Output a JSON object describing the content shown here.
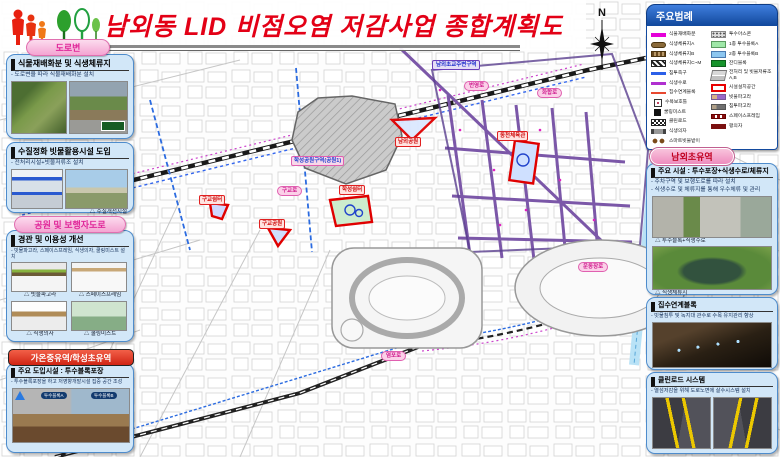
{
  "header": {
    "title": "남외동 LID 비점오염 저감사업 종합계획도"
  },
  "left_column": {
    "pill_road": "도로변",
    "panel1": {
      "title": "식물재배화분 및 식생체류지",
      "subtitle": "- 도로변을 따라 식물재배화분 설치"
    },
    "panel2": {
      "title": "수질정화 빗물활용시설 도입",
      "subtitle": "- 전처리시설+빗물저류조 설치",
      "caption": "△ 수질개선시설"
    },
    "pill_park": "공원 및 보행자도로",
    "panel3": {
      "title": "경관 및 이용성 개선",
      "subtitle": "- 빗물파고라, 스페이스프레임, 식생의자, 쿨링미스트 설치",
      "captions": [
        "△ 빗물파고라",
        "△ 스페이스프레임",
        "△ 식생의자",
        "△ 쿨링미스트"
      ]
    },
    "pill_watershed": "가온중유역/학성초유역",
    "panel4": {
      "title": "주요 도입시설 : 투수블록포장",
      "subtitle": "- 투수블록포장을 하고 저영향개발시설 집중 공간 조성",
      "image_tags": [
        "투수블록A",
        "투수블록B"
      ]
    }
  },
  "legend": {
    "title": "주요범례",
    "left": [
      {
        "label": "식물재배화분"
      },
      {
        "label": "식생체류지A"
      },
      {
        "label": "식생체류지B"
      },
      {
        "label": "식생체류지C~M"
      },
      {
        "label": "침투측구"
      },
      {
        "label": "식생수로"
      },
      {
        "label": "집수연계블록"
      },
      {
        "label": "수목보호틀"
      },
      {
        "label": "쿨링미스트"
      },
      {
        "label": "클린로드"
      },
      {
        "label": "식생의자"
      },
      {
        "label": "스마트빗물받이"
      }
    ],
    "right": [
      {
        "label": "투수아스콘"
      },
      {
        "label": "1종 투수블록A"
      },
      {
        "label": "2종 투수블록B"
      },
      {
        "label": "잔디블록"
      },
      {
        "label": "전처리 및 빗물저류조A,B"
      },
      {
        "label": "시설설치공간"
      },
      {
        "label": "빗물파고라"
      },
      {
        "label": "침투파고라"
      },
      {
        "label": "스페이스프레임"
      },
      {
        "label": "평의자"
      }
    ]
  },
  "right_column": {
    "pill": "남외초유역",
    "panelA": {
      "title": "주요 시설 : 투수포장+식생수로/체류지",
      "subtitle1": "- 주차구역 및 보행도로를 따라 설치",
      "subtitle2": "- 식생수로 및 체류지를 통해 우수체류 및 관리",
      "caption1": "△ 투수블록+식생수로",
      "caption2": "△ 식생체류지"
    },
    "panelB": {
      "title": "집수연계블록",
      "subtitle": "- 빗물침투 및 녹지대 관수로 수목 유지관리 향상"
    },
    "panelC": {
      "title": "클린로드 시스템",
      "subtitle": "- 열섬저감을 위해 도로노면에 살수시스템 설치"
    }
  },
  "map": {
    "compass": "N",
    "labels": [
      {
        "text": "남외초교주변구역"
      },
      {
        "text": "번영로"
      },
      {
        "text": "화합로"
      },
      {
        "text": "구교로"
      },
      {
        "text": "염포로"
      },
      {
        "text": "운동장로"
      },
      {
        "text": "학성공원구역(공원1)"
      },
      {
        "text": "남외공원"
      },
      {
        "text": "동천체육관"
      },
      {
        "text": "구교쉼터"
      },
      {
        "text": "구교공원"
      },
      {
        "text": "학성쉼터"
      }
    ]
  },
  "colors": {
    "title_red": "#e30016",
    "legend_blue": "#134a9e",
    "panel_blue": "#d2e7f8",
    "pill_pink": "#f4a4d2",
    "facility_red": "#e00000",
    "lid_purple": "#7b57a8"
  }
}
